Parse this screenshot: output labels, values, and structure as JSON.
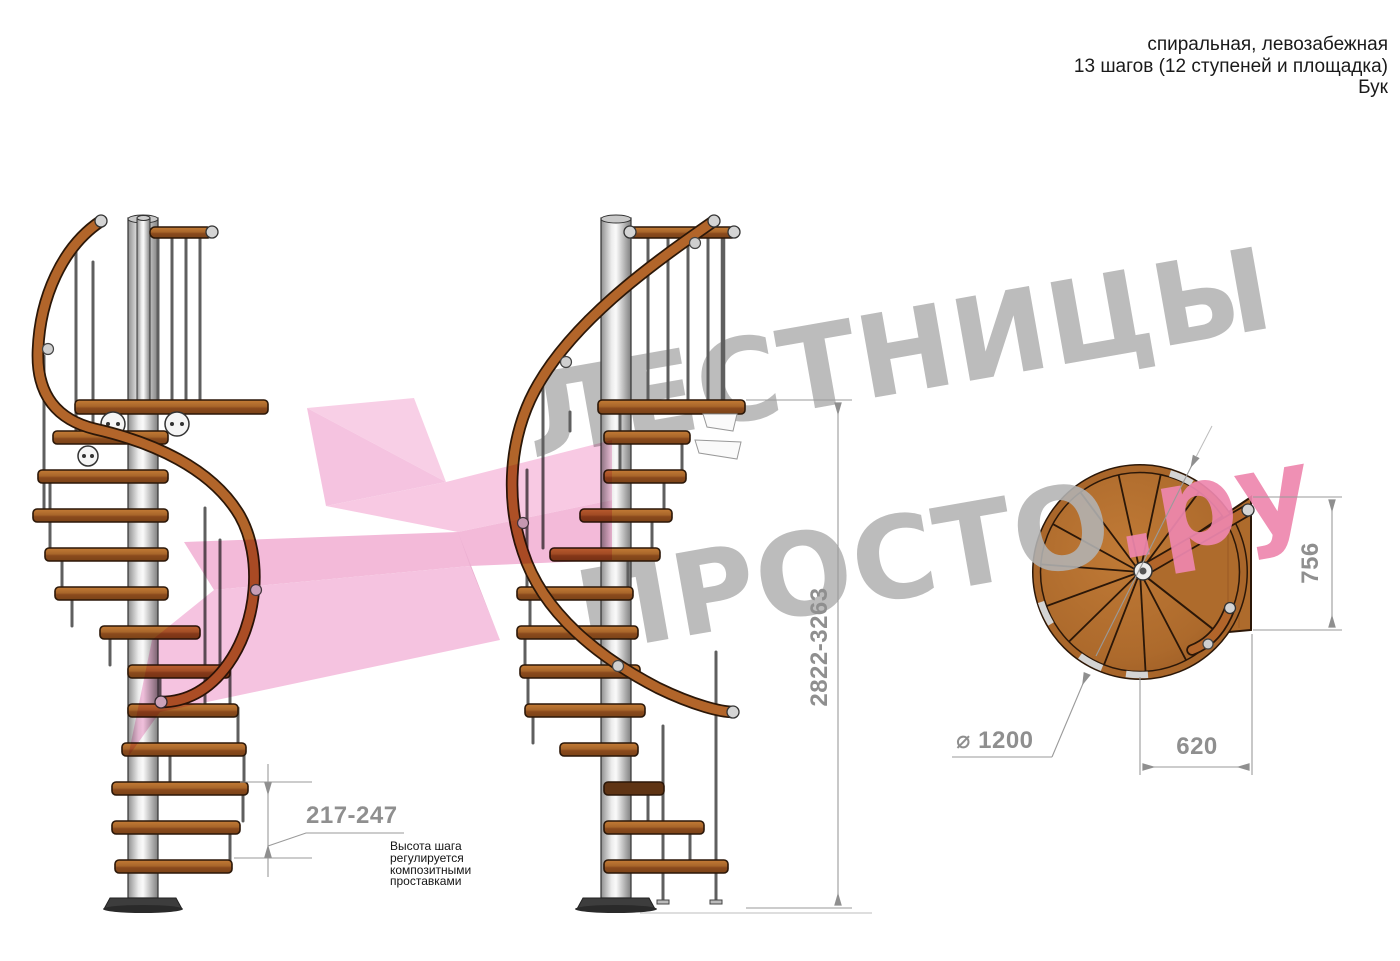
{
  "header": {
    "line1": "спиральная, левозабежная",
    "line2": "13 шагов (12 ступеней и площадка)",
    "line3": "Бук"
  },
  "watermark": {
    "line1": "ЛЕСТНИЦЫ",
    "line2_gray": "ПРОСТО",
    "line2_pink": ".ру"
  },
  "dimensions": {
    "total_height": "2822-3263",
    "step_height": "217-247",
    "diameter": "⌀ 1200",
    "landing_width": "620",
    "landing_depth": "756"
  },
  "note": "Высота шага\nрегулируется\nкомпозитными\nпроставками",
  "colors": {
    "wood": "#b2652a",
    "wood_dark": "#7a4318",
    "metal_gray": "#d9d9d9",
    "watermark_gray": "#b3b3b3",
    "watermark_pink": "#ee87ae",
    "arrow_pink": "#f3b4d8",
    "dimension_gray": "#8f8f8f",
    "text_black": "#1a1a1a"
  }
}
